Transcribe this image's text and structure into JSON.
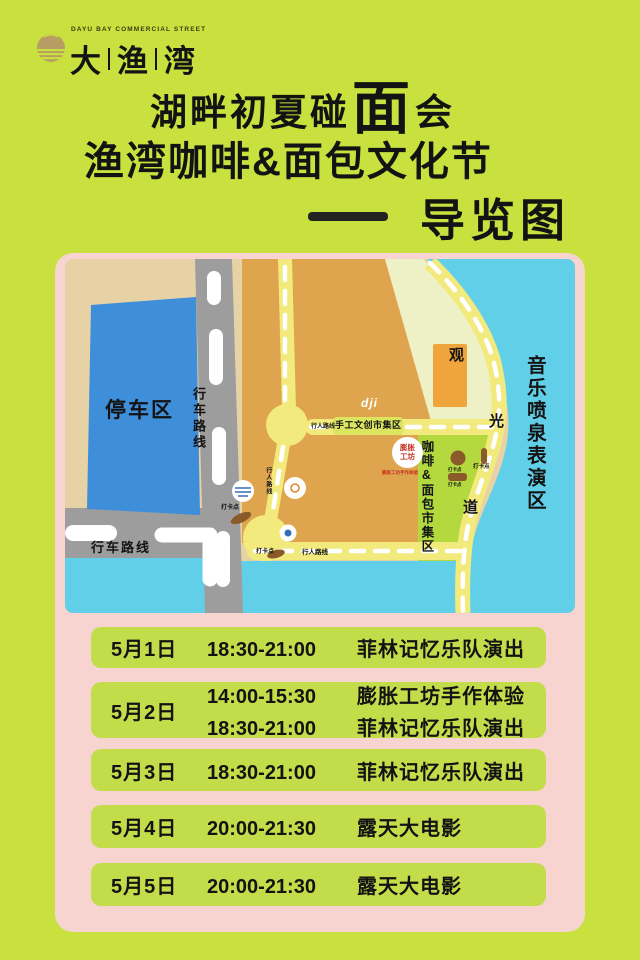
{
  "colors": {
    "page_bg": "#c8e13e",
    "card_bg": "#f7d4d0",
    "row_bg": "#c3dc49",
    "text": "#131313",
    "logo_gold": "#b79d63"
  },
  "logo": {
    "tagline": "DAYU BAY COMMERCIAL STREET",
    "char1": "大",
    "char2": "渔",
    "char3": "湾"
  },
  "title": {
    "line1_pre": "湖畔初夏碰",
    "line1_big": "面",
    "line1_post": "会",
    "line2": "渔湾咖啡&面包文化节",
    "line3": "导览图"
  },
  "map": {
    "labels": {
      "parking": "停车区",
      "drive_route": "行车路线",
      "walk_route": "行人路线",
      "checkin": "打卡点",
      "fountain_zone": "音乐喷泉表演区",
      "sight1": "观",
      "sight2": "光",
      "sight3": "道",
      "craft_market": "手工文创市集区",
      "coffee_market": "咖啡&面包市集区",
      "dji": "dji",
      "workshop_top": "膨胀",
      "workshop_bottom": "工坊",
      "workshop_note": "膨胀工坊手作体验"
    },
    "colors": {
      "sand": "#e7d2a6",
      "orange": "#dfa54e",
      "cream": "#eef0c5",
      "orange_stage": "#f0a43c",
      "green_market": "#b4d93f",
      "craft_strip": "#dbe55f",
      "sea": "#62cfe9",
      "road": "#9d9d9d",
      "parking": "#3f8ed9",
      "path": "#f2ea7c",
      "brown": "#8a5a2a"
    }
  },
  "schedule": [
    {
      "date": "5月1日",
      "items": [
        {
          "time": "18:30-21:00",
          "event": "菲林记忆乐队演出"
        }
      ]
    },
    {
      "date": "5月2日",
      "items": [
        {
          "time": "14:00-15:30",
          "event": "膨胀工坊手作体验"
        },
        {
          "time": "18:30-21:00",
          "event": "菲林记忆乐队演出"
        }
      ]
    },
    {
      "date": "5月3日",
      "items": [
        {
          "time": "18:30-21:00",
          "event": "菲林记忆乐队演出"
        }
      ]
    },
    {
      "date": "5月4日",
      "items": [
        {
          "time": "20:00-21:30",
          "event": "露天大电影"
        }
      ]
    },
    {
      "date": "5月5日",
      "items": [
        {
          "time": "20:00-21:30",
          "event": "露天大电影"
        }
      ]
    }
  ]
}
